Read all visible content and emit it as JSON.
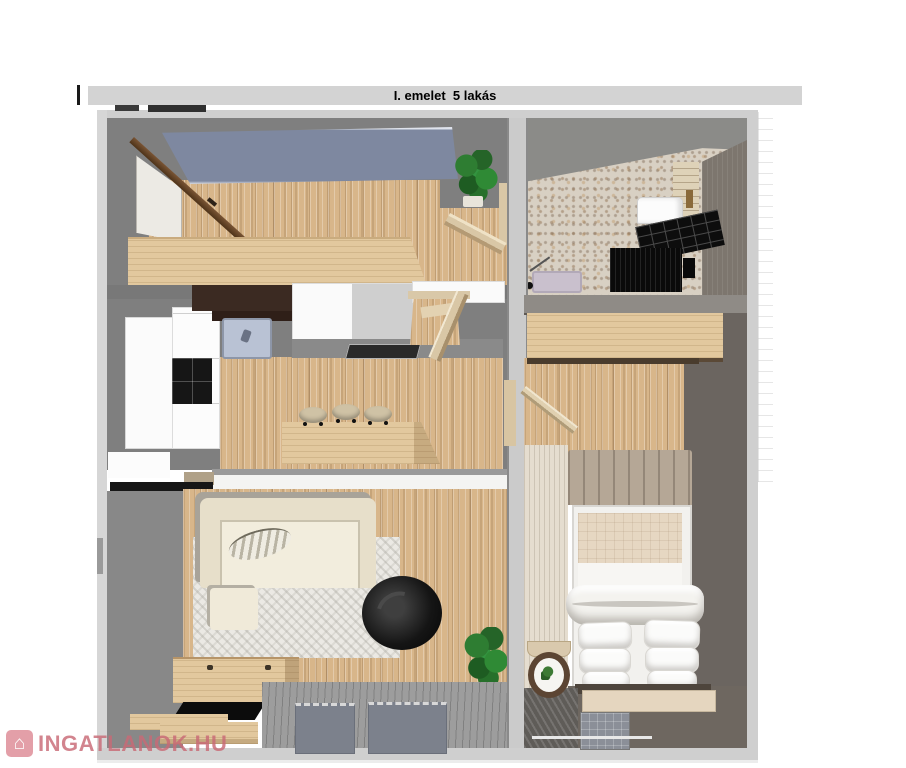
{
  "header": {
    "title": "I. emelet  5 lakás"
  },
  "watermark": {
    "brand": "INGATLANOK.HU",
    "icon": "house-icon",
    "house_glyph": "⌂"
  },
  "palette": {
    "title_bar_gray": "#d3d3d3",
    "outer_wall_light": "#cfcfcf",
    "inner_wall_gray": "#7f7f7f",
    "bedroom_wall_dark": "#6b6560",
    "wood_floor": "#d8b68a",
    "light_wood_counter": "#e2c89e",
    "accent_panel_blue": "#7e88a0",
    "terrazzo_floor": "#d8d0c3",
    "rug_white": "#ebe9e4",
    "sofa_cream": "#e7dfca",
    "black_furniture": "#141414",
    "terrace_gray": "#9d9d9d",
    "mat_gray_blue": "#7c818c",
    "plant_green": "#2e7d32",
    "sink_lavender": "#c9c0cd",
    "watermark_pink": "#c96a76"
  }
}
